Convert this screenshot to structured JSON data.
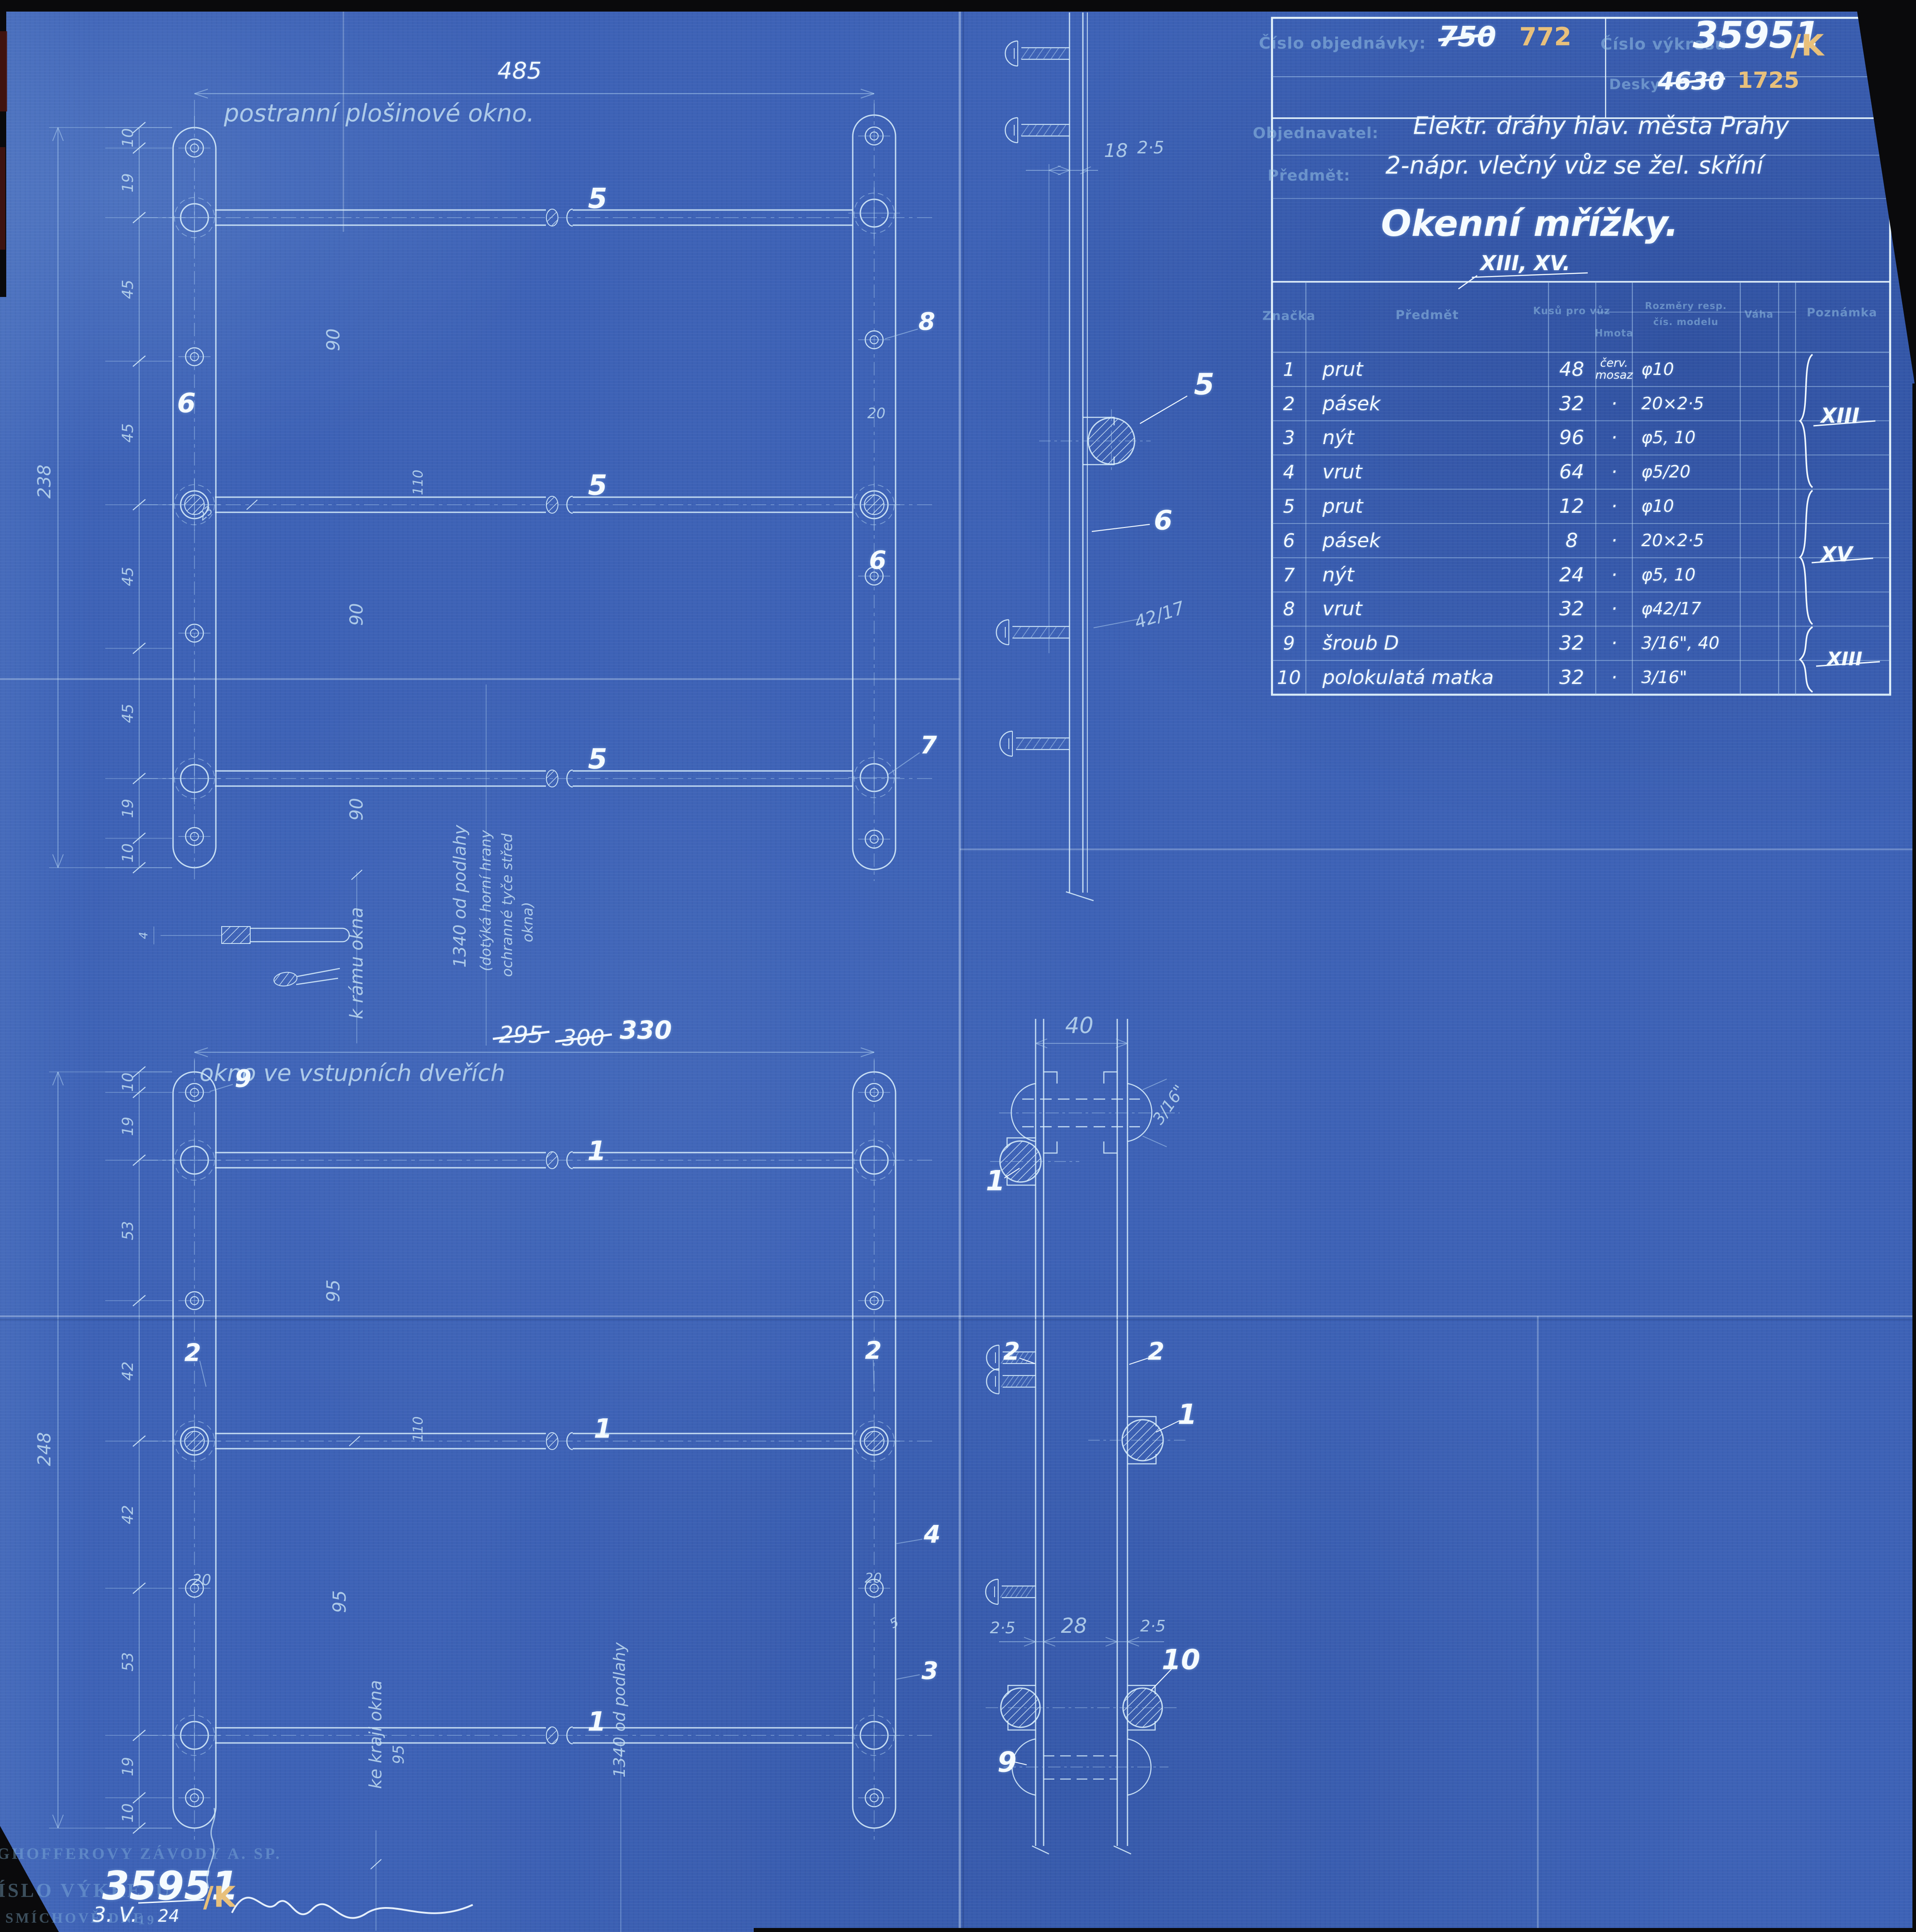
{
  "title_block": {
    "order_label": "Číslo objednávky:",
    "order_old": "750",
    "order_new": "772",
    "drawing_no_label": "Číslo výkresu",
    "drawing_no": "35951",
    "drawing_no_suffix": "/K",
    "desky_label": "Desky",
    "desky_old": "4630",
    "desky_new": "1725",
    "customer_label": "Objednavatel:",
    "customer": "Elektr. dráhy hlav. města Prahy",
    "subject_label": "Předmět:",
    "subject": "2-nápr. vlečný vůz se žel. skříní",
    "title": "Okenní mřížky.",
    "sheet_numbers": "XIII, XV."
  },
  "parts_table": {
    "col_znacka": "Značka",
    "col_predmet": "Předmět",
    "col_kusu": "Kusů pro vůz",
    "col_hmota": "Hmota",
    "col_rozmery": "Rozměry resp.",
    "col_rozmery2": "čís. modelu",
    "col_vaha": "Váha",
    "col_poznamka": "Poznámka",
    "rows": [
      {
        "znacka": "1",
        "predmet": "prut",
        "kusu": "48",
        "hmota": "červ. mosaz",
        "rozmery": "φ10"
      },
      {
        "znacka": "2",
        "predmet": "pásek",
        "kusu": "32",
        "hmota": "·",
        "rozmery": "20×2·5"
      },
      {
        "znacka": "3",
        "predmet": "nýt",
        "kusu": "96",
        "hmota": "·",
        "rozmery": "φ5, 10"
      },
      {
        "znacka": "4",
        "predmet": "vrut",
        "kusu": "64",
        "hmota": "·",
        "rozmery": "φ5/20"
      },
      {
        "znacka": "5",
        "predmet": "prut",
        "kusu": "12",
        "hmota": "·",
        "rozmery": "φ10"
      },
      {
        "znacka": "6",
        "predmet": "pásek",
        "kusu": "8",
        "hmota": "·",
        "rozmery": "20×2·5"
      },
      {
        "znacka": "7",
        "predmet": "nýt",
        "kusu": "24",
        "hmota": "·",
        "rozmery": "φ5, 10"
      },
      {
        "znacka": "8",
        "predmet": "vrut",
        "kusu": "32",
        "hmota": "·",
        "rozmery": "φ42/17"
      },
      {
        "znacka": "9",
        "predmet": "šroub D",
        "kusu": "32",
        "hmota": "·",
        "rozmery": "3/16\", 40"
      },
      {
        "znacka": "10",
        "predmet": "polokulatá matka",
        "kusu": "32",
        "hmota": "·",
        "rozmery": "3/16\""
      }
    ],
    "group_labels": [
      "XIII",
      "XV",
      "XIII"
    ]
  },
  "upper_drawing": {
    "caption": "postranní plošinové okno.",
    "width_dim": "485",
    "rod_label": "5",
    "callout_8": "8",
    "callout_6a": "6",
    "callout_6b": "6",
    "callout_7": "7",
    "dim_20": "20",
    "dim_23": "23",
    "dim_110": "110",
    "dim_90a": "90",
    "dim_90b": "90",
    "dim_90c": "90",
    "left_dims": [
      "10",
      "19",
      "45",
      "45",
      "45",
      "45",
      "19",
      "10"
    ],
    "total_dim": "238",
    "detail_dim": "4",
    "note_frame": "k rámu okna",
    "note_floor_1": "1340 od podlahy",
    "note_floor_2": "(dotýká horní hrany",
    "note_floor_3": "ochranné tyče střed",
    "note_floor_4": "okna)"
  },
  "upper_section": {
    "dim_18": "18",
    "dim_25": "2·5",
    "callout_5": "5",
    "callout_6": "6",
    "screw_dim": "42/17"
  },
  "lower_drawing": {
    "caption": "okno ve vstupních dveřích",
    "dim_old1": "295",
    "dim_old2": "300",
    "dim_new": "330",
    "rod_label": "1",
    "callout_9": "9",
    "callout_2a": "2",
    "callout_2b": "2",
    "callout_4": "4",
    "callout_3": "3",
    "dim_20a": "20",
    "dim_20b": "20",
    "dim_5": "5",
    "dim_110": "110",
    "dim_95a": "95",
    "dim_95b": "95",
    "left_dims": [
      "10",
      "19",
      "53",
      "42",
      "42",
      "53",
      "19",
      "10"
    ],
    "total_dim": "248",
    "note_edge_1": "ke kraji okna",
    "note_edge_2": "95",
    "note_floor": "1340 od podlahy"
  },
  "lower_section": {
    "dim_40": "40",
    "dim_316": "3/16\"",
    "callout_1a": "1",
    "callout_1b": "1",
    "callout_2a": "2",
    "callout_2b": "2",
    "callout_9": "9",
    "callout_10": "10",
    "dim_25a": "2·5",
    "dim_28": "28",
    "dim_25b": "2·5"
  },
  "footer": {
    "stamp_company": "RINGHOFFEROVY ZÁVODY A. SP.",
    "stamp_drawing_label": "ČÍSLO VÝKRESU",
    "drawing_no": "35951",
    "drawing_no_suffix": "/K",
    "stamp_place": "NA SMÍCHOVĚ DNE",
    "date_day": "3. V.",
    "date_century": "19",
    "date_year": "24"
  }
}
